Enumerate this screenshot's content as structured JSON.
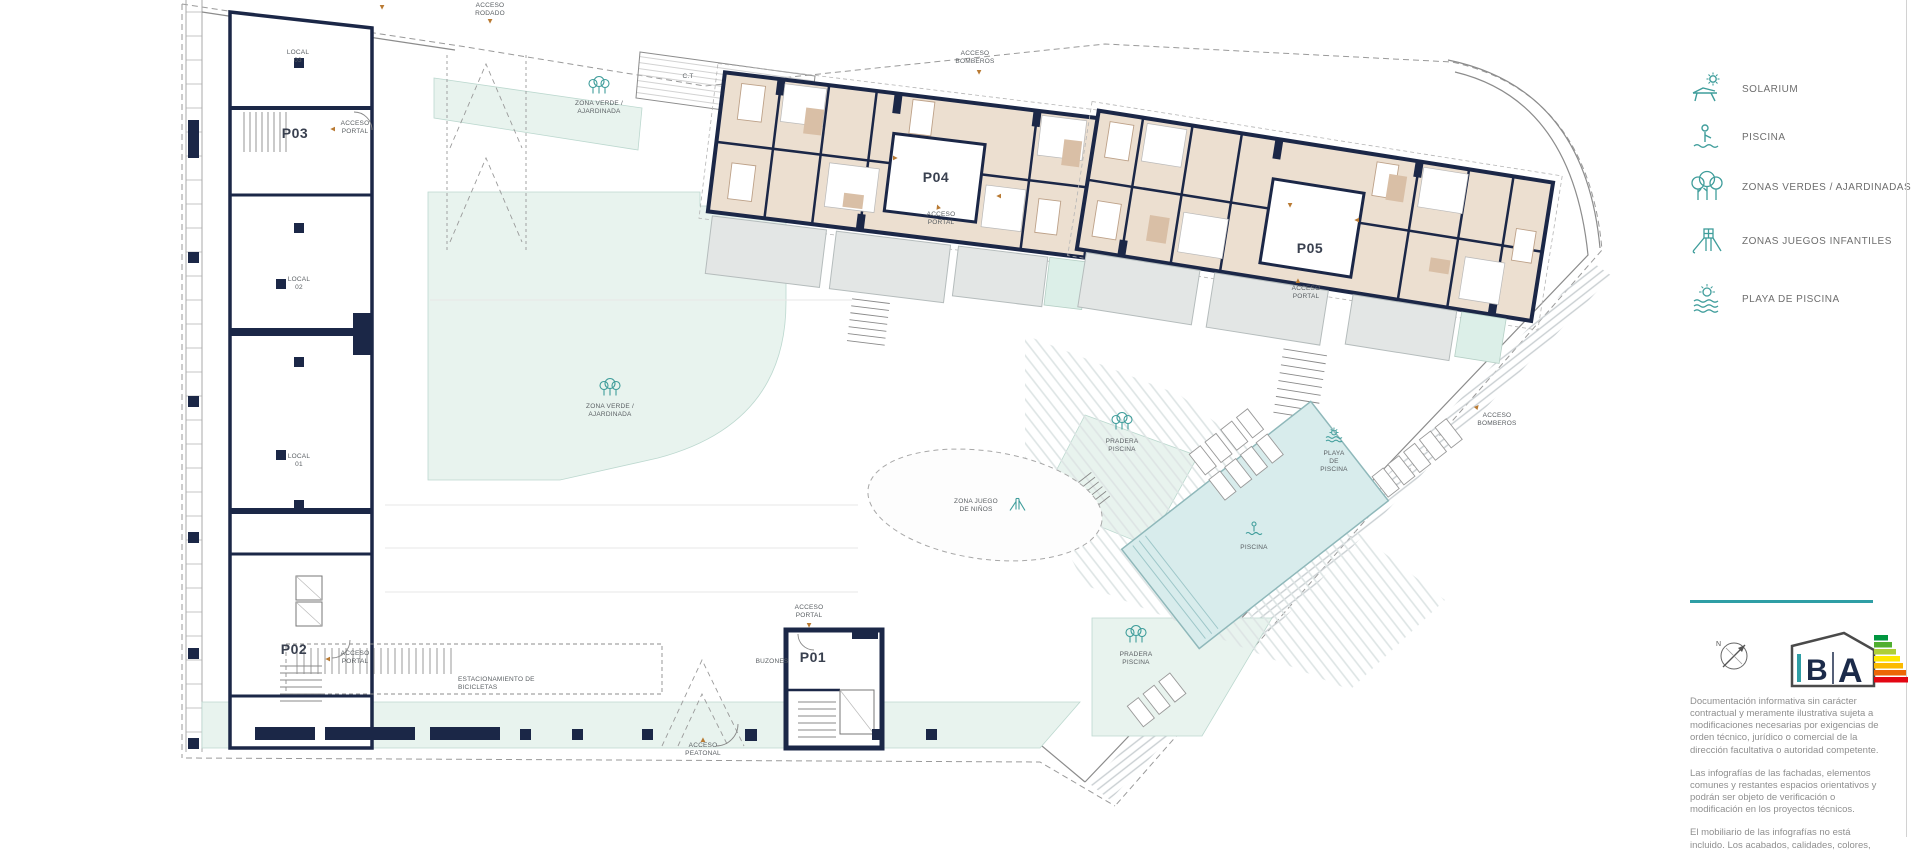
{
  "colors": {
    "teal_accent": "#2f9ea5",
    "icon_teal": "#3f9d9b",
    "wall_navy": "#1b2747",
    "apartment_beige": "#ecdfd0",
    "green_zone": "#e8f3ee",
    "terrace_gray": "#e3e6e5",
    "pool_blue": "#d8ecec",
    "arrow_orange": "#b97a33"
  },
  "plan": {
    "portals": {
      "p01": "P01",
      "p02": "P02",
      "p03": "P03",
      "p04": "P04",
      "p05": "P05"
    },
    "locals": {
      "top": "LOCAL\n03",
      "middle": "LOCAL\n02",
      "bottom": "LOCAL\n01"
    },
    "labels": {
      "acceso_rodado": "ACCESO\nRODADO",
      "acceso_bomberos": "ACCESO\nBOMBEROS",
      "acceso_portal": "ACCESO\nPORTAL",
      "acceso_peatonal": "ACCESO\nPEATONAL",
      "zona_verde": "ZONA VERDE /\nAJARDINADA",
      "zona_juego": "ZONA JUEGO\nDE NIÑOS",
      "pradera_piscina": "PRADERA\nPISCINA",
      "playa_piscina": "PLAYA\nDE\nPISCINA",
      "piscina": "PISCINA",
      "ct": "C.T",
      "buzones": "BUZONES",
      "estacionamiento_bicicletas": "ESTACIONAMIENTO DE\nBICICLETAS"
    },
    "icons": {
      "arrow": "▲"
    },
    "compass_n": "N"
  },
  "legend": {
    "items": [
      {
        "id": "solarium",
        "label": "SOLARIUM"
      },
      {
        "id": "piscina",
        "label": "PISCINA"
      },
      {
        "id": "zonas_verdes",
        "label": "ZONAS VERDES / AJARDINADAS"
      },
      {
        "id": "zonas_juegos",
        "label": "ZONAS JUEGOS INFANTILES"
      },
      {
        "id": "playa_piscina",
        "label": "PLAYA DE PISCINA"
      }
    ]
  },
  "energy_logo": {
    "letter_b": "B",
    "letter_a": "A"
  },
  "info_panel": {
    "paragraphs": [
      "Documentación informativa sin carácter contractual y meramente ilustrativa sujeta a modificaciones necesarias por exigencias de orden técnico, jurídico o comercial de la dirección facultativa o autoridad competente.",
      "Las infografías de las fachadas, elementos comunes y restantes espacios orientativos y podrán ser objeto de verificación o modificación en los proyectos técnicos.",
      "El mobiliario de las infografías no está incluido. Los acabados, calidades, colores,"
    ]
  }
}
